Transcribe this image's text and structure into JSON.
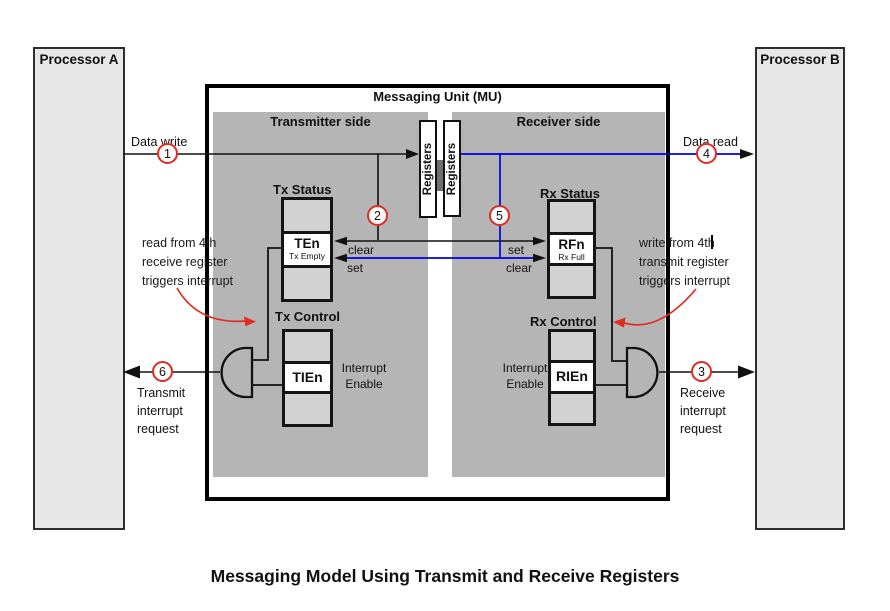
{
  "colors": {
    "accent_red": "#e02b20",
    "wire_blue": "#0000dd",
    "panel_gray": "#b5b5b5"
  },
  "caption": "Messaging Model Using Transmit and Receive Registers",
  "processors": {
    "a": "Processor A",
    "b": "Processor B"
  },
  "mu": {
    "title": "Messaging Unit (MU)",
    "register_file_left": "Registers",
    "register_file_right": "Registers",
    "transmitter": {
      "panel_label": "Transmitter side",
      "status_label": "Tx Status",
      "status_register": "TEn",
      "status_register_sub": "Tx Empty",
      "clear_label": "clear",
      "set_label": "set",
      "control_label": "Tx Control",
      "control_register": "TIEn",
      "enable_lines": [
        "Interrupt",
        "Enable"
      ]
    },
    "receiver": {
      "panel_label": "Receiver side",
      "status_label": "Rx Status",
      "status_register": "RFn",
      "status_register_sub": "Rx Full",
      "set_label": "set",
      "clear_label": "clear",
      "control_label": "Rx Control",
      "control_register": "RIEn",
      "enable_lines": [
        "Interrupt",
        "Enable"
      ]
    }
  },
  "flows": {
    "data_write": {
      "label": "Data write",
      "step": "1"
    },
    "data_read": {
      "label": "Data read",
      "step": "4"
    },
    "tx_clear_step": "2",
    "rx_set_step": "5",
    "transmit_interrupt": {
      "step": "6",
      "lines": [
        "Transmit",
        "interrupt",
        "request"
      ]
    },
    "receive_interrupt": {
      "step": "3",
      "lines": [
        "Receive",
        "interrupt",
        "request"
      ]
    }
  },
  "annotations": {
    "left": {
      "lines": [
        "read from 4th",
        "receive register",
        "triggers interrupt"
      ]
    },
    "right": {
      "lines": [
        "write from 4th",
        "transmit register",
        "triggers interrupt"
      ]
    }
  }
}
